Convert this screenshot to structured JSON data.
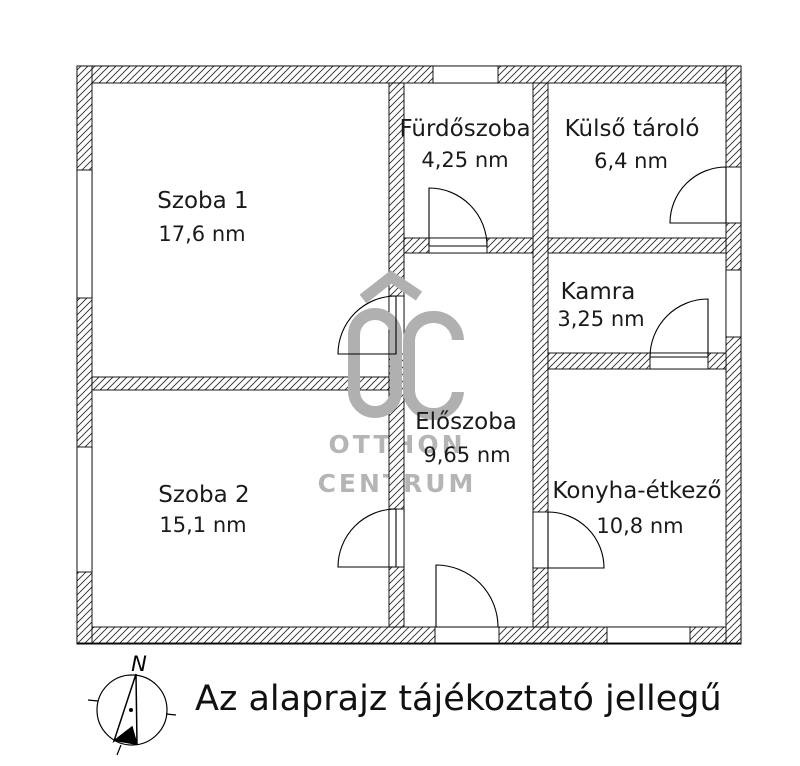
{
  "floor_plan": {
    "rooms": [
      {
        "name": "Szoba 1",
        "area": "17,6 nm"
      },
      {
        "name": "Szoba 2",
        "area": "15,1 nm"
      },
      {
        "name": "Fürdőszoba",
        "area": "4,25 nm"
      },
      {
        "name": "Külső tároló",
        "area": "6,4 nm"
      },
      {
        "name": "Kamra",
        "area": "3,25 nm"
      },
      {
        "name": "Előszoba",
        "area": "9,65 nm"
      },
      {
        "name": "Konyha-étkező",
        "area": "10,8 nm"
      }
    ]
  },
  "watermark": {
    "logo": "OC",
    "line1": "OTTHON",
    "line2": "CENTRUM",
    "color": "#b0b0b0"
  },
  "compass": {
    "north_label": "N"
  },
  "footer": {
    "disclaimer": "Az alaprajz tájékoztató jellegű"
  },
  "colors": {
    "background": "#ffffff",
    "line": "#000000",
    "watermark": "#b0b0b0"
  }
}
